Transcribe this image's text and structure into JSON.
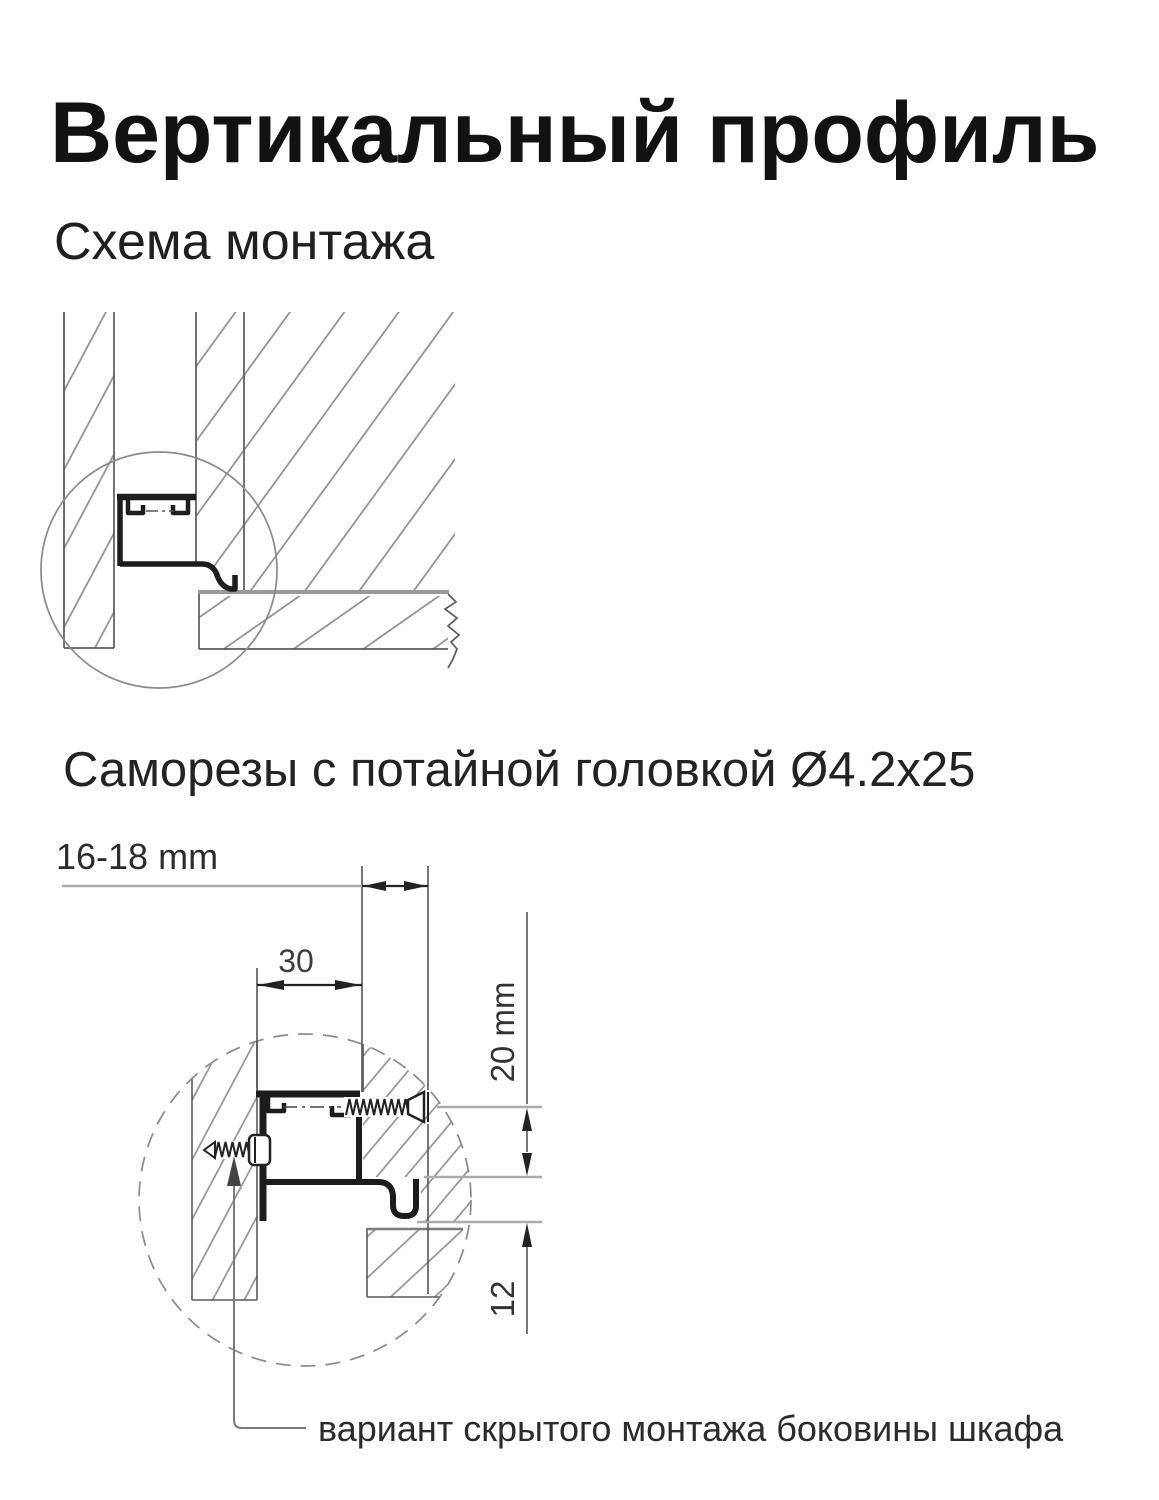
{
  "header": {
    "title": "Вертикальный профиль",
    "subtitle": "Схема монтажа"
  },
  "section_screws": {
    "heading": "Саморезы с потайной головкой Ø4.2x25"
  },
  "diagram_overview": {
    "description": "mounting-scheme cross-section with detail circle"
  },
  "diagram_detail": {
    "dim_panel_thickness": "16-18 mm",
    "dim_profile_width": "30",
    "dim_screw_offset": "20 mm",
    "dim_bottom_clearance": "12",
    "leader_caption": "вариант скрытого монтажа боковины шкафа"
  },
  "colors": {
    "background": "#ffffff",
    "line_dark": "#1c1c1c",
    "line_medium": "#555555",
    "line_light": "#a8a8a8",
    "hatch": "#8d8d8d",
    "text": "#222222"
  }
}
